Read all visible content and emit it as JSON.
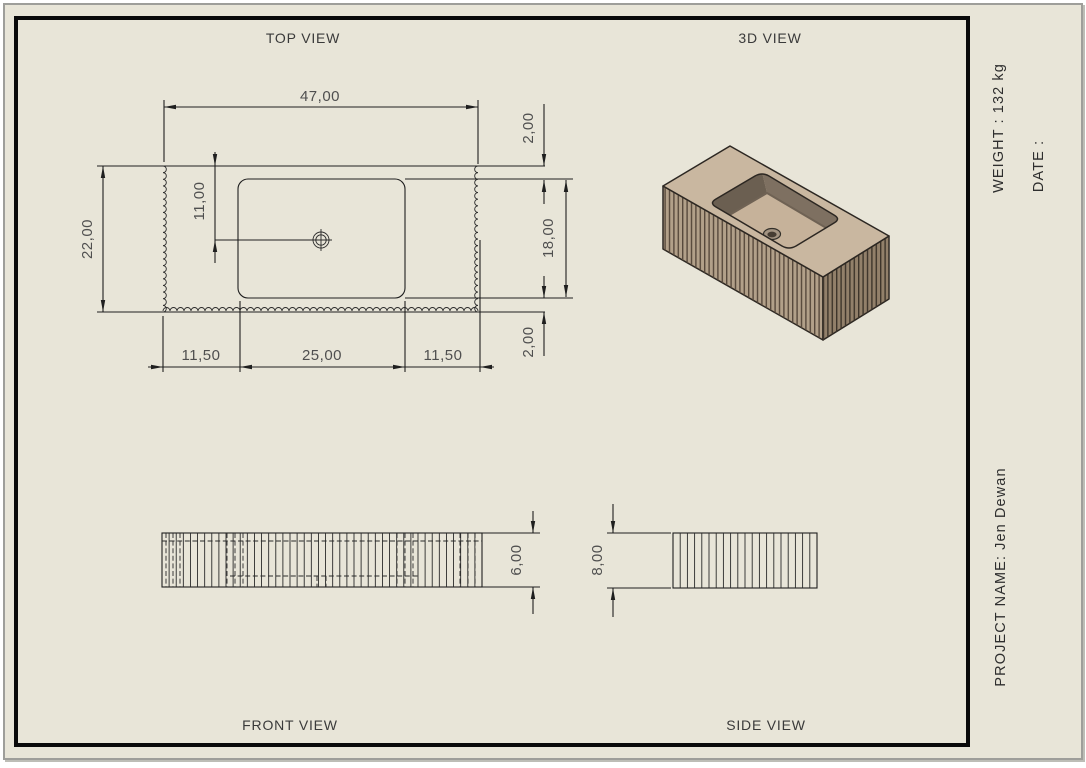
{
  "sheet": {
    "type": "technical-drawing",
    "subject": "fluted rectangular sink basin"
  },
  "views": {
    "top_label": "TOP VIEW",
    "threed_label": "3D VIEW",
    "front_label": "FRONT VIEW",
    "side_label": "SIDE VIEW"
  },
  "title_block": {
    "weight": "WEIGHT : 132 kg",
    "date": "DATE :",
    "project": "PROJECT NAME: Jen Dewan"
  },
  "dimensions": {
    "top_view": {
      "overall_width": "47,00",
      "overall_depth": "22,00",
      "drain_offset": "11,00",
      "rim_top": "2,00",
      "basin_depth": "18,00",
      "rim_bottom": "2,00",
      "left_margin": "11,50",
      "basin_width": "25,00",
      "right_margin": "11,50"
    },
    "front_view": {
      "height": "6,00"
    },
    "side_view": {
      "height": "8,00"
    }
  },
  "colors": {
    "sheet_bg": "#e8e5d8",
    "line": "#1f1f1f",
    "deck": "#c9b7a0",
    "face_left": "#b2a089",
    "face_right": "#92806a",
    "flute_left": "#57493c",
    "flute_right": "#3e352b",
    "wall_nw": "#6b5f51",
    "wall_ne": "#7e7061",
    "wall_se": "#a6947e",
    "wall_sw": "#b7a48c",
    "floor": "#c6b29a",
    "drain_outer": "#a39482",
    "drain_inner": "#463d33",
    "edge": "#2c2722"
  }
}
